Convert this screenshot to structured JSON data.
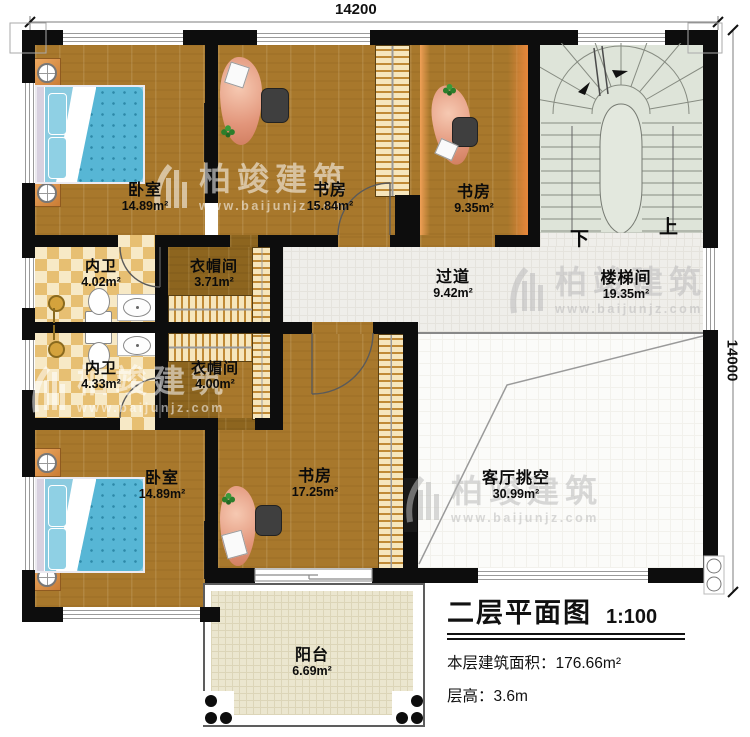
{
  "watermark": {
    "brand": "柏竣建筑",
    "url": "www.baijunjz.com"
  },
  "dimensions": {
    "top": "14200",
    "right": "14000"
  },
  "stair": {
    "down": "下",
    "up": "上"
  },
  "rooms": {
    "bedroom1": {
      "name": "卧室",
      "area": "14.89m²"
    },
    "study1": {
      "name": "书房",
      "area": "15.84m²"
    },
    "study2": {
      "name": "书房",
      "area": "9.35m²"
    },
    "bath1": {
      "name": "内卫",
      "area": "4.02m²"
    },
    "cloak1": {
      "name": "衣帽间",
      "area": "3.71m²"
    },
    "corridor": {
      "name": "过道",
      "area": "9.42m²"
    },
    "stairwell": {
      "name": "楼梯间",
      "area": "19.35m²"
    },
    "bath2": {
      "name": "内卫",
      "area": "4.33m²"
    },
    "cloak2": {
      "name": "衣帽间",
      "area": "4.00m²"
    },
    "bedroom2": {
      "name": "卧室",
      "area": "14.89m²"
    },
    "study3": {
      "name": "书房",
      "area": "17.25m²"
    },
    "void": {
      "name": "客厅挑空",
      "area": "30.99m²"
    },
    "balcony": {
      "name": "阳台",
      "area": "6.69m²"
    }
  },
  "title_block": {
    "title": "二层平面图",
    "scale": "1:100",
    "floor_area": "本层建筑面积：176.66m²",
    "floor_height": "层高：3.6m"
  },
  "colors": {
    "wall": "#0d0d0d",
    "wood": "#a8782c",
    "wood_dark": "#8d651f",
    "tile_dark": "#e7bf72",
    "tile_light": "#f7e9c6",
    "corridor": "#efeeea",
    "stair": "#dee4d9",
    "balcony": "#ebe6cf",
    "desk": "#e2957a",
    "bed": "#57b6d5",
    "accent_orange": "#e8873b"
  }
}
